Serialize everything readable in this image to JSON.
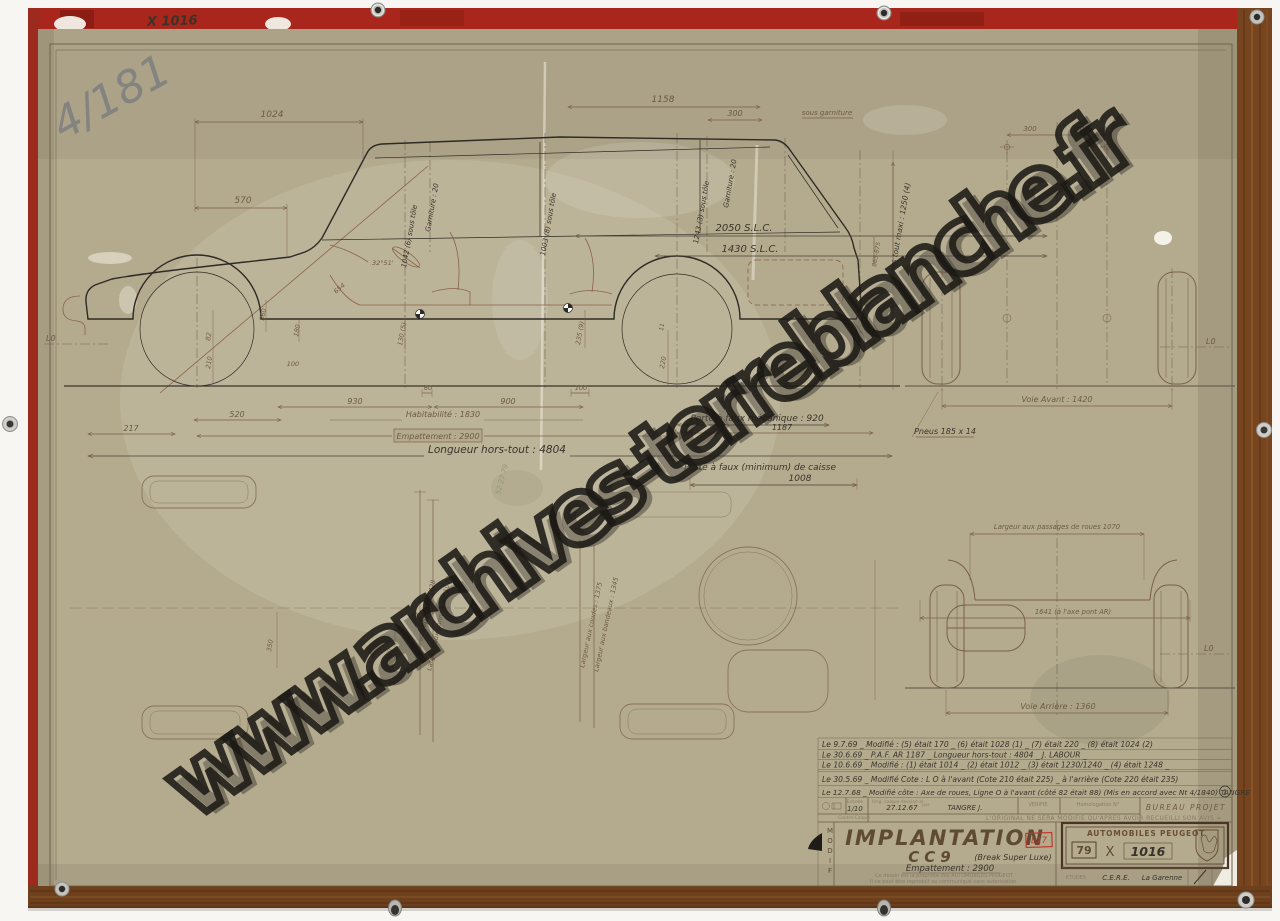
{
  "photo": {
    "watermark": "www.archives-terreblanche.fr",
    "plate_code": "X 1016",
    "pencil_ref": "4/181",
    "pencil_note": "52 27 79"
  },
  "side_view": {
    "dim_1024": "1024",
    "dim_570": "570",
    "dim_1158": "1158",
    "dim_300": "300",
    "sous_garniture": "sous garniture",
    "garniture_front": "Garniture : 20",
    "garniture_rear": "Garniture : 20",
    "tole_front": "1042 (6) sous tôle",
    "tole_mid": "1003 (8) sous tôle",
    "tole_rear": "1243 (3) sous tôle",
    "hors_tout_maxi": "hors tout maxi : 1250 (4)",
    "dim_865": "865-875",
    "slc_2050": "2050 S.L.C.",
    "slc_1430": "1430 S.L.C.",
    "angle": "32°51'",
    "dim_654": "654",
    "dim_360": "360",
    "dim_180": "180",
    "dim_100_front": "100",
    "dim_82": "82",
    "dim_210": "210",
    "dim_220": "220",
    "dim_11": "11",
    "dim_235": "235 (9)",
    "dim_130": "130 (5)",
    "dim_60": "60",
    "dim_100_rear": "100",
    "dim_930": "930",
    "dim_900": "900",
    "dim_520": "520",
    "dim_217": "217",
    "habitabilite": "Habitabilité : 1830",
    "empattement": "Empattement : 2900",
    "dim_1187": "1187",
    "longueur_hors_tout": "Longueur hors-tout : 4804",
    "porte_a_faux_meca": "Porte à faux mécanique : 920",
    "porte_a_faux_caisse": "Porte à faux (minimum) de caisse",
    "porte_a_faux_caisse_val": "1008",
    "ligne_zero": "L0"
  },
  "front_view": {
    "dim_300_left": "300",
    "dim_300_right": "300",
    "voie_avant": "Voie Avant : 1420",
    "pneus": "Pneus 185 x 14",
    "ligne_zero": "L0"
  },
  "rear_view": {
    "passages_roues": "Largeur aux passages de roues 1070",
    "axe_pont": "1641 (à l'axe pont AR)",
    "voie_arriere": "Voie Arrière : 1360",
    "ligne_zero": "L0"
  },
  "plan_view": {
    "dim_350": "350",
    "dim_360": "360",
    "epaules": "Largeur aux épaules : 1428",
    "panneaux": "Largeur aux panneaux : 1070",
    "coudes": "Largeur aux coudes : 1375",
    "bandeaux": "Largeur aux bandeaux : 1345"
  },
  "revisions": {
    "rows": [
      "Le 9.7.69 _ Modifié : (5) était 170 _ (6) était 1028 (1) _ (7) était 220 _ (8) était 1024 (2)",
      "Le 30.6.69 _ P.A.F. AR 1187 _ Longueur hors-tout : 4804 _ J. LABOUR _",
      "Le 10.6.69 _ Modifié : (1) était 1014 _ (2) était 1012 _ (3) était 1230/1240 _ (4) était 1248 _",
      "Le 30.5.69 _ Modifié Cote : L O à l'avant (Cote 210 était 225) _ à l'arrière (Cote 220 était 235)",
      "Le 12.7.68 _ Modifié côte : Axe de roues, Ligne O à l'avant (côté 82 était 88) (Mis en accord avec Nt 4/1840) TANGRE"
    ],
    "rev_badge": "1"
  },
  "cartouche": {
    "modif_label": "MODIF",
    "echelle_label": "Echelle",
    "echelle_value": "1/10",
    "orig_label": "Orig. calque dessiné le",
    "orig_date": "27.12.67",
    "par_label": "par",
    "author": "TANGRE J.",
    "verifie_label": "VERIFIE",
    "homologation_label": "Homologation N°",
    "bureau": "BUREAU PROJET",
    "contre_calque_label": "Contre-Calque",
    "original_notice": "L'ORIGINAL NE SERA MODIFIE QU'APRES AVOIR RECUEILLI SON AVIS =",
    "title": "IMPLANTATION",
    "model": "CC9",
    "variant": "(Break Super Luxe)",
    "empattement": "Empattement : 2900",
    "stamp": "E17",
    "brand": "AUTOMOBILES PEUGEOT",
    "ref_series": "79",
    "ref_letter": "X",
    "ref_number": "1016",
    "etudes_label": "ETUDES",
    "etudes_value": "C.E.R.E.",
    "site": "La Garenne",
    "property_line1": "Ce dessin est la propriété des AUTOMOBILES PEUGEOT",
    "property_line2": "Il ne peut être reproduit ou communiqué sans autorisation."
  },
  "colors": {
    "paper": "#b4ab8f",
    "board_red": "#a8261b",
    "wood": "#76451f",
    "ink": "#3a332a",
    "brown_line": "#7d5f46",
    "red_stamp": "#c3362b"
  }
}
